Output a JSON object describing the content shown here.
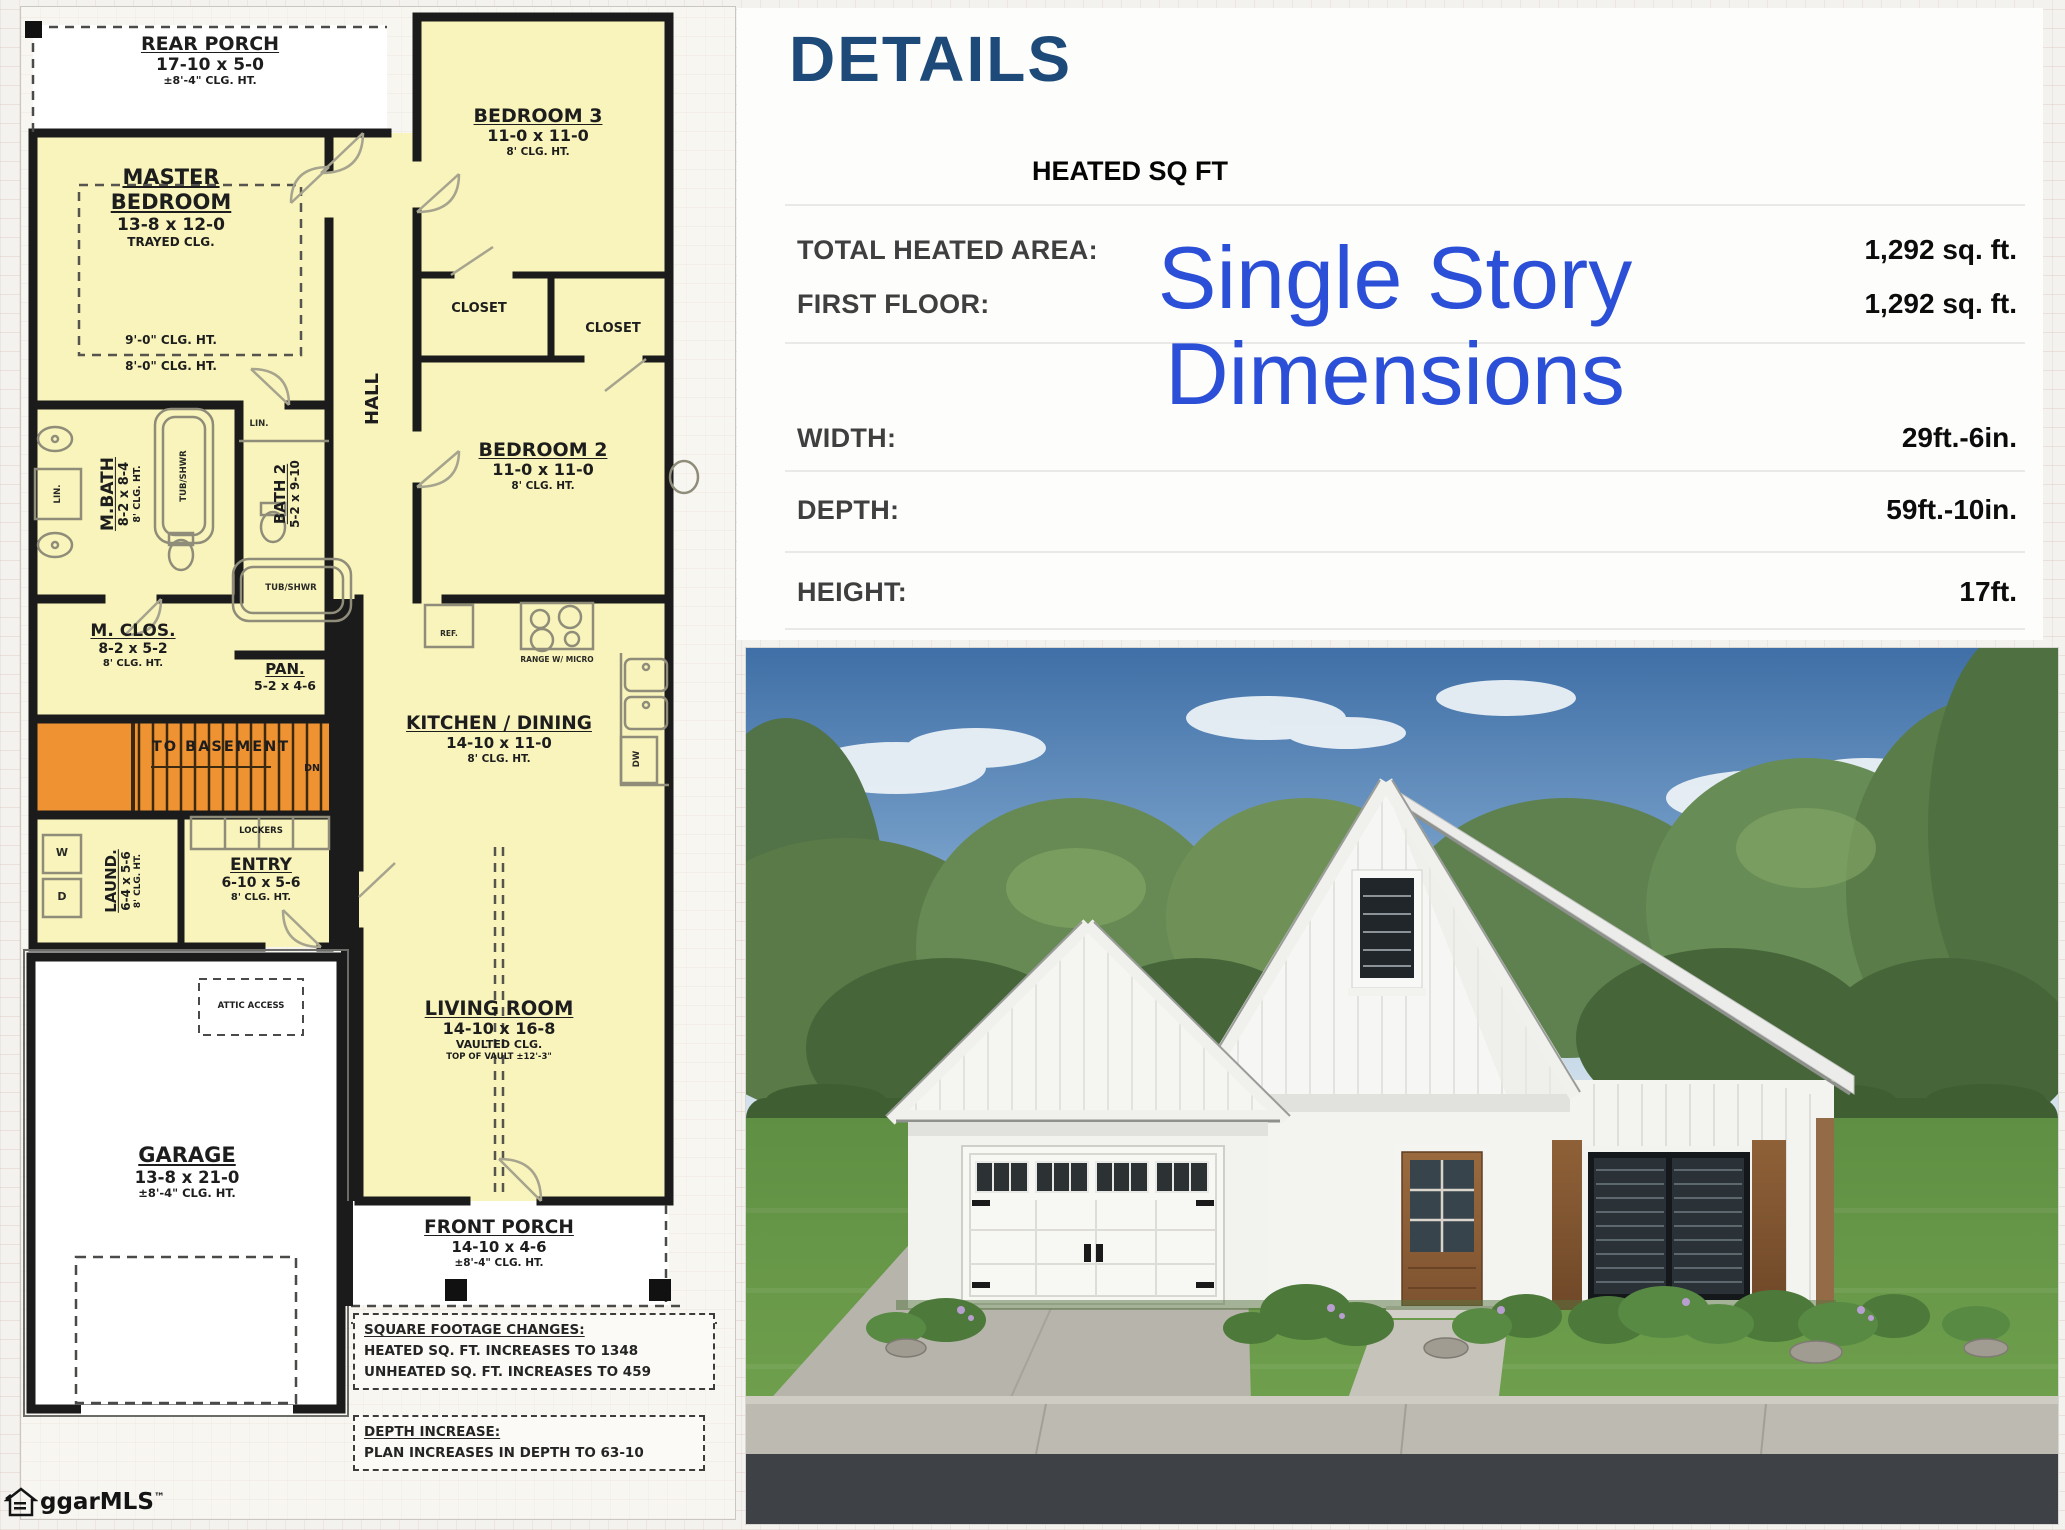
{
  "branding": {
    "logo_text": "ggarMLS",
    "trademark": "™"
  },
  "details": {
    "title": "DETAILS",
    "section_header": "HEATED SQ FT",
    "rows": [
      {
        "label": "TOTAL HEATED AREA:",
        "value": "1,292 sq. ft."
      },
      {
        "label": "FIRST FLOOR:",
        "value": "1,292 sq. ft."
      },
      {
        "label": "WIDTH:",
        "value": "29ft.-6in."
      },
      {
        "label": "DEPTH:",
        "value": "59ft.-10in."
      },
      {
        "label": "HEIGHT:",
        "value": "17ft."
      }
    ],
    "overlay": {
      "line1": "Single Story",
      "line2": "Dimensions"
    },
    "colors": {
      "title": "#1d4a78",
      "overlay": "#2b4fd7"
    }
  },
  "plan": {
    "colors": {
      "room_fill": "#f8f4bb",
      "wall": "#1b1b1b",
      "stairs_fill": "#ef9231",
      "unheated_fill": "#ffffff"
    },
    "rooms": {
      "rear_porch": {
        "name": "REAR PORCH",
        "dims": "17-10 x 5-0",
        "note": "±8'-4\" CLG. HT."
      },
      "master": {
        "name": "MASTER",
        "name2": "BEDROOM",
        "dims": "13-8 x 12-0",
        "note": "TRAYED CLG.",
        "clg1": "9'-0\" CLG. HT.",
        "clg2": "8'-0\" CLG. HT."
      },
      "bedroom3": {
        "name": "BEDROOM 3",
        "dims": "11-0 x 11-0",
        "note": "8' CLG. HT."
      },
      "closet_a": {
        "name": "CLOSET"
      },
      "closet_b": {
        "name": "CLOSET"
      },
      "hall": {
        "name": "HALL"
      },
      "bedroom2": {
        "name": "BEDROOM 2",
        "dims": "11-0 x 11-0",
        "note": "8' CLG. HT."
      },
      "mbath": {
        "name": "M.BATH",
        "dims": "8-2 x 8-4",
        "note": "8' CLG. HT."
      },
      "bath2": {
        "name": "BATH 2",
        "dims": "5-2 x 9-10"
      },
      "mclos": {
        "name": "M. CLOS.",
        "dims": "8-2 x 5-2",
        "note": "8' CLG. HT."
      },
      "pan": {
        "name": "PAN.",
        "dims": "5-2 x 4-6"
      },
      "basement": {
        "name": "TO BASEMENT",
        "dn": "DN"
      },
      "laund": {
        "name": "LAUND.",
        "dims": "6-4 x 5-6",
        "note": "8' CLG. HT."
      },
      "lockers": {
        "name": "LOCKERS"
      },
      "entry": {
        "name": "ENTRY",
        "dims": "6-10 x 5-6",
        "note": "8' CLG. HT."
      },
      "kitchen": {
        "name": "KITCHEN / DINING",
        "dims": "14-10 x 11-0",
        "note": "8' CLG. HT."
      },
      "living": {
        "name": "LIVING ROOM",
        "dims": "14-10 x 16-8",
        "note": "VAULTED CLG.",
        "note2": "TOP OF VAULT ±12'-3\""
      },
      "garage": {
        "name": "GARAGE",
        "dims": "13-8 x 21-0",
        "note": "±8'-4\" CLG. HT."
      },
      "front_porch": {
        "name": "FRONT PORCH",
        "dims": "14-10 x 4-6",
        "note": "±8'-4\" CLG. HT."
      },
      "attic": {
        "name": "ATTIC ACCESS"
      }
    },
    "fixtures": {
      "lin": "LIN.",
      "tub": "TUB/SHWR",
      "ref": "REF.",
      "range": "RANGE W/ MICRO",
      "dw": "DW",
      "washer": "W",
      "dryer": "D"
    },
    "notes": {
      "sqft_title": "SQUARE FOOTAGE CHANGES:",
      "sqft_line1": "HEATED SQ. FT. INCREASES TO 1348",
      "sqft_line2": "UNHEATED SQ. FT. INCREASES TO 459",
      "depth_title": "DEPTH INCREASE:",
      "depth_line1": "PLAN INCREASES IN DEPTH TO 63-10"
    }
  }
}
